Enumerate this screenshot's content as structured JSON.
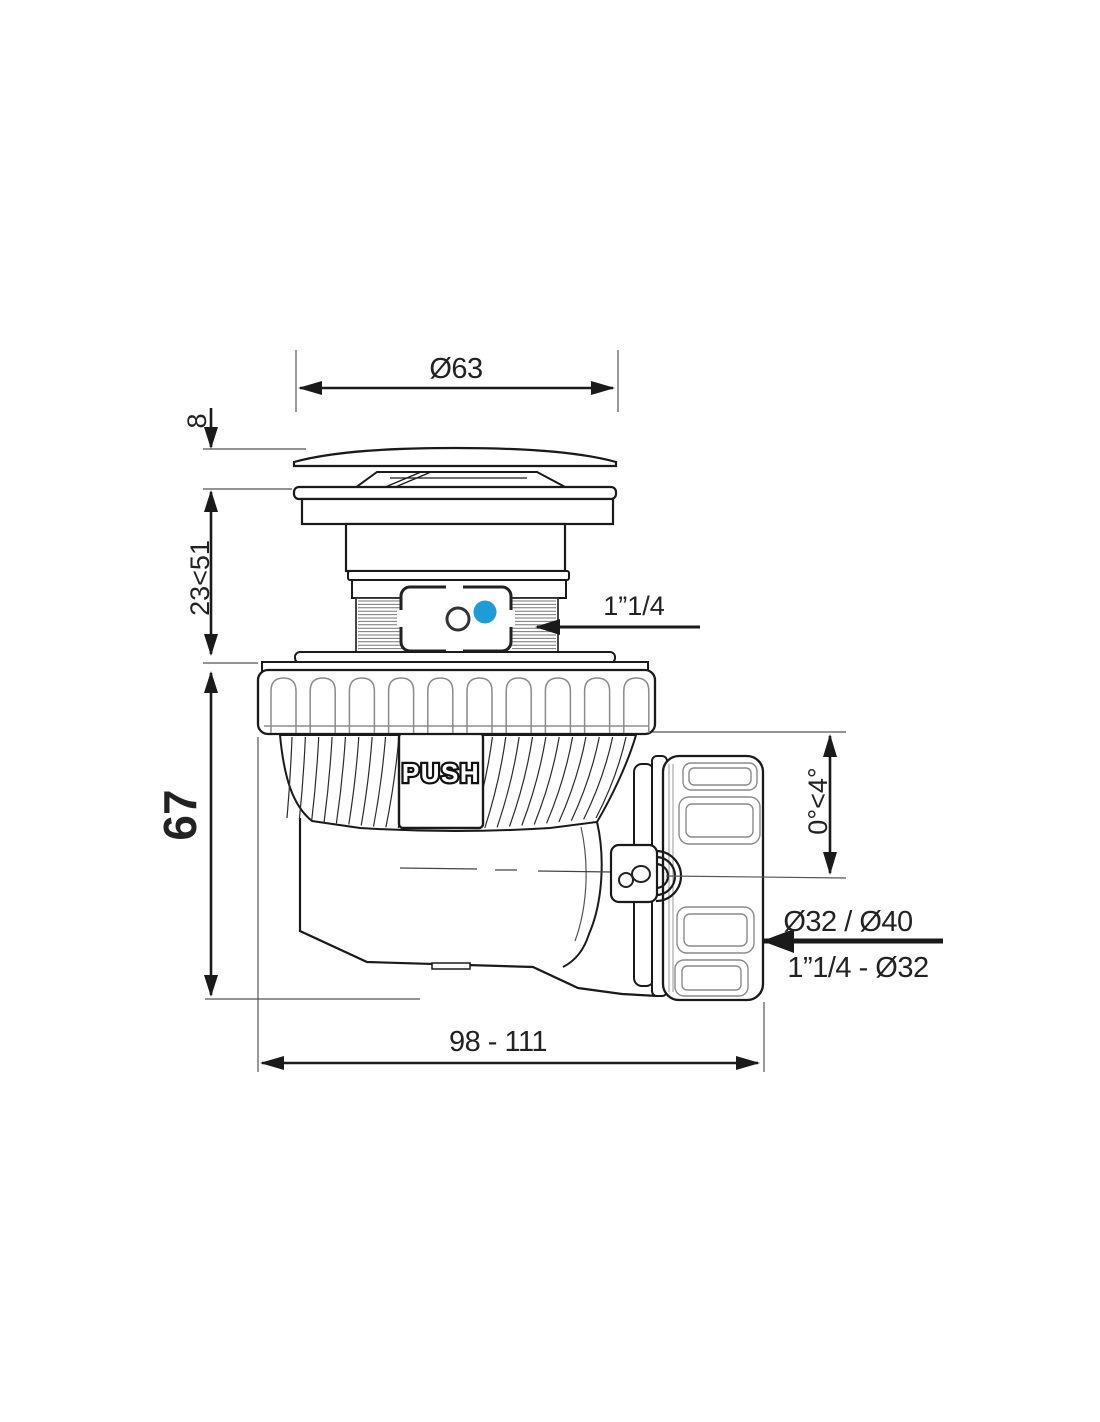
{
  "drawing": {
    "kind": "technical dimensional drawing",
    "view": "side view of push-open waste drain with swivel outlet elbow"
  },
  "labels": {
    "dia_top": "Ø63",
    "cap_height": "8",
    "adjust_range": "23<51",
    "body_height": "67",
    "inlet_thread": "1”1/4",
    "push": "PUSH",
    "angle_range": "0°<4°",
    "outlet_dia": "Ø32 / Ø40",
    "outlet_thread": "1”1/4 - Ø32",
    "length_range": "98 - 111"
  },
  "colors": {
    "line": "#1a1a1a",
    "dim_text": "#222222",
    "accent_blue": "#1e9cd7",
    "light_detail": "#8a8a8a"
  }
}
